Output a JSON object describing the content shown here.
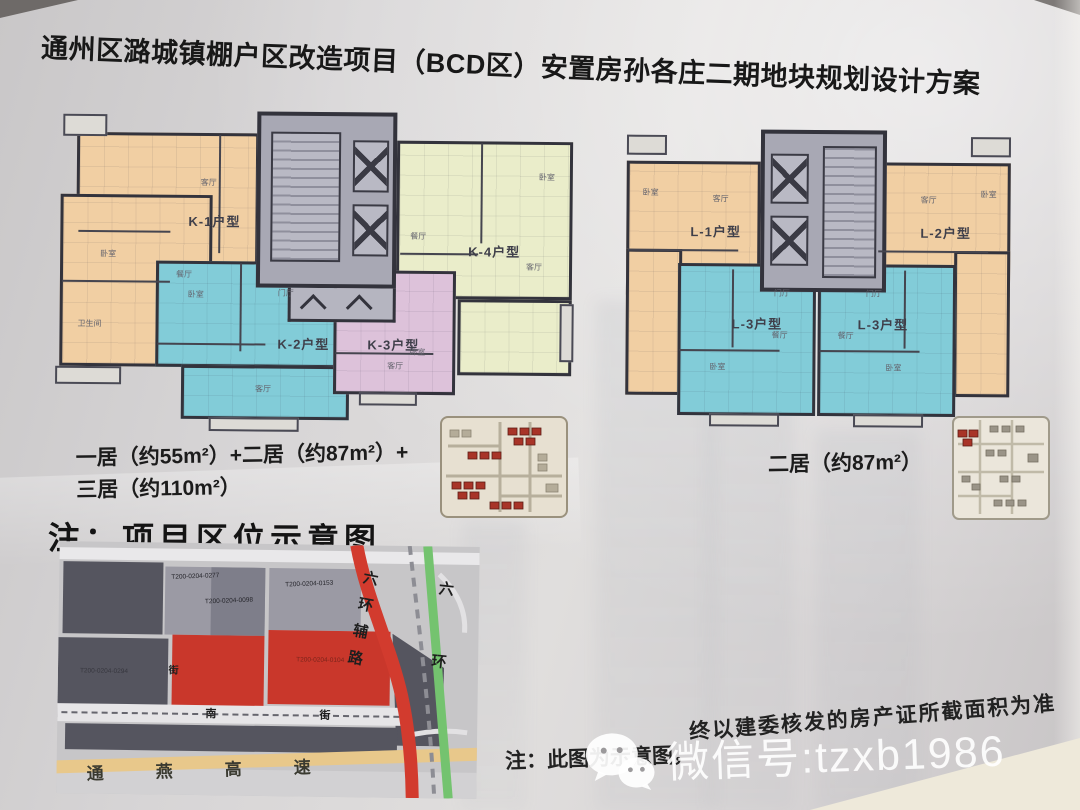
{
  "title": "通州区潞城镇棚户区改造项目（BCD区）安置房孙各庄二期地块规划设计方案",
  "plans": {
    "left": {
      "units": [
        {
          "label": "K-1户型"
        },
        {
          "label": "K-2户型"
        },
        {
          "label": "K-3户型"
        },
        {
          "label": "K-4户型"
        }
      ],
      "caption_line1": "一居（约55m²）+二居（约87m²）+",
      "caption_line2": "三居（约110m²）"
    },
    "right": {
      "units": [
        {
          "label": "L-1户型"
        },
        {
          "label": "L-2户型"
        },
        {
          "label": "L-3户型"
        },
        {
          "label": "L-3户型"
        }
      ],
      "caption": "二居（约87m²）"
    }
  },
  "rooms": {
    "bedroom": "卧室",
    "living": "客厅",
    "dining": "餐厅",
    "foyer": "门厅",
    "kitchen": "厨房",
    "bath": "卫生间"
  },
  "location": {
    "heading": "注：项目区位示意图",
    "map": {
      "parcels": {
        "code1": "T200-0204-0277",
        "code2": "T200-0204-0098",
        "code3": "T200-0204-0153",
        "code4": "T200-0204-0294",
        "code5": "T200-0204-0104"
      },
      "roads": {
        "expressway": "通燕高速",
        "ring_aux": "六环辅路",
        "ring": "六环",
        "street_char1": "南",
        "street_char2": "街",
        "street_char3": "街"
      }
    }
  },
  "footnote": {
    "part1": "注：此图为示意图，",
    "part2": "终以建委核发的房产证所截面积为准"
  },
  "watermark": {
    "wechat_label": "微信号:tzxb1986"
  },
  "colors": {
    "unit_orange": "#f1cfa3",
    "unit_green": "#eaedca",
    "unit_blue": "#82ccd8",
    "unit_pink": "#ddc2da",
    "core_gray": "#a8a8b4",
    "parcel_red": "#c9372b",
    "road_red": "#d23b2e",
    "road_green": "#74c36f",
    "road_yellow": "#e8c88b"
  }
}
